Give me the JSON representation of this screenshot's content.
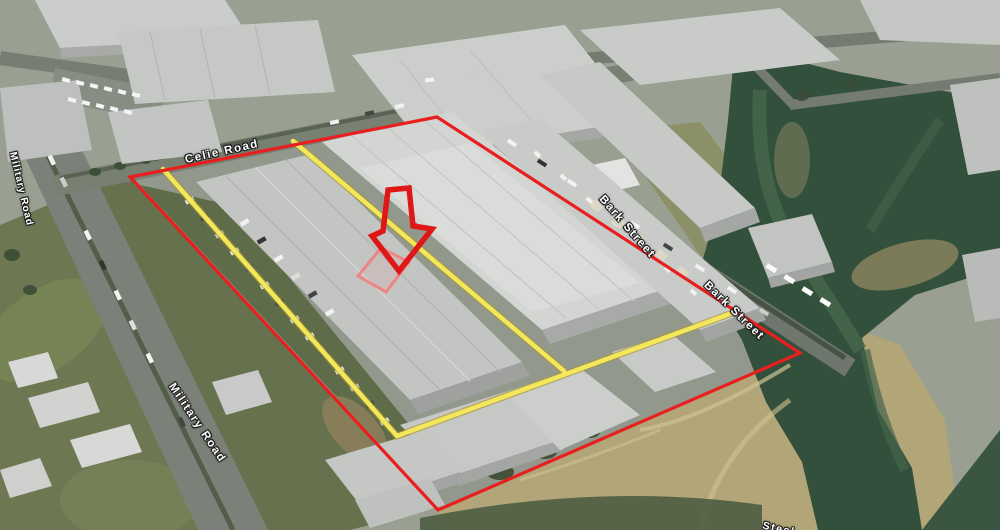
{
  "map": {
    "view_type": "aerial-3d-satellite-view",
    "road_labels": [
      {
        "id": "celie-road",
        "text": "Celie Road"
      },
      {
        "id": "military-road-upper",
        "text": "Military Road"
      },
      {
        "id": "military-road-lower",
        "text": "Military Road"
      },
      {
        "id": "bark-street-upper",
        "text": "Bark Street"
      },
      {
        "id": "bark-street-lower",
        "text": "Bark Street"
      },
      {
        "id": "road-partial-bottom",
        "text": "Steel"
      }
    ],
    "annotations": {
      "site_boundary_color": "#e81f1f",
      "inner_boundary_color": "#f3e75c",
      "inner_boundary_edge_color": "#a9952f",
      "arrow_color": "#de1717",
      "highlight_box_color": "#f37f7f"
    }
  }
}
